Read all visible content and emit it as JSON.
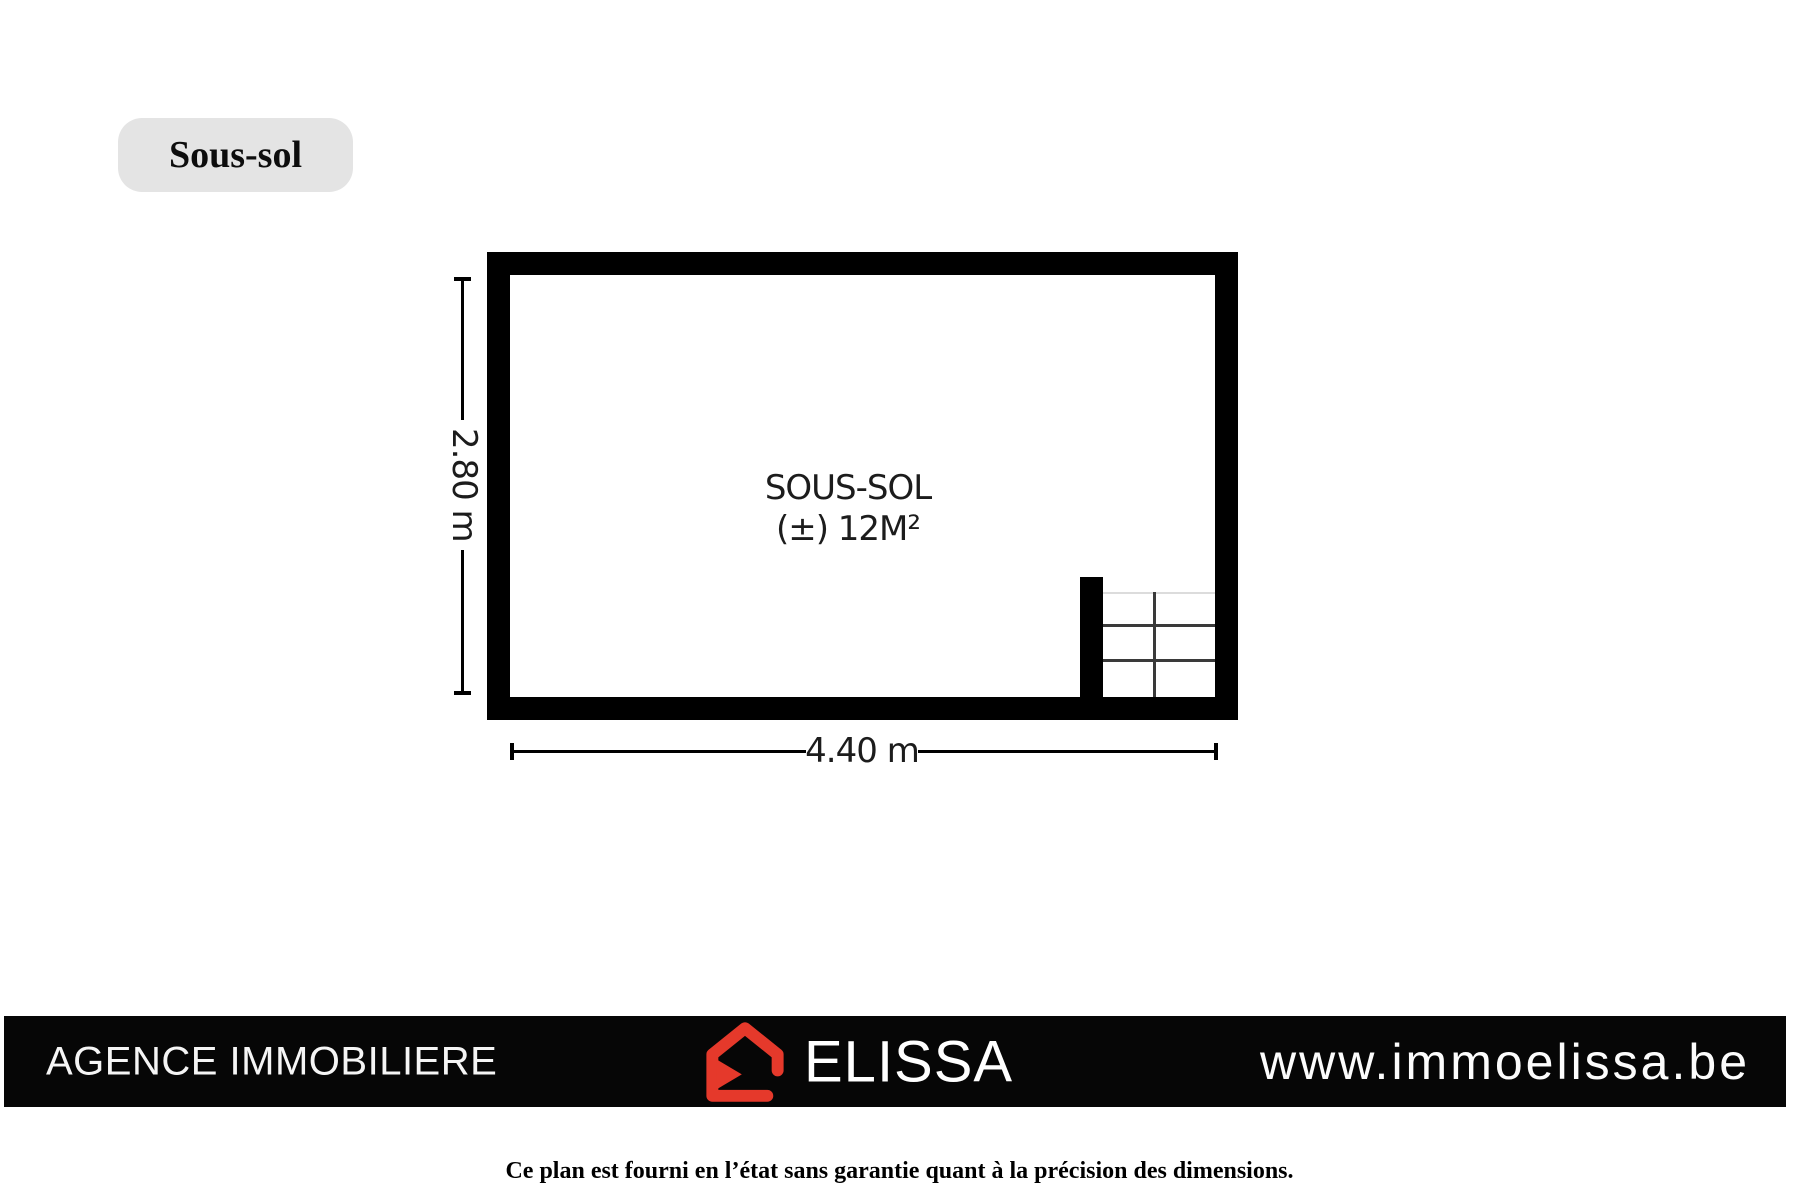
{
  "page": {
    "background": "#ffffff",
    "floor_badge": {
      "label": "Sous-sol",
      "bg_color": "#e4e4e4"
    },
    "disclaimer": "Ce plan est fourni en l’état sans garantie quant à la précision des dimensions."
  },
  "plan": {
    "wall_color": "#000000",
    "room": {
      "name": "SOUS-SOL",
      "area": "(±) 12M²"
    },
    "dimensions": {
      "height": "2.80 m",
      "width": "4.40 m"
    },
    "stairs": {
      "columns": 2,
      "rows": 3,
      "position": "bottom-right"
    }
  },
  "footer": {
    "bar_color": "#060606",
    "agency_text": "AGENCE IMMOBILIERE",
    "brand_name": "ELISSA",
    "website": "www.immoelissa.be",
    "logo_icon": "house-icon",
    "logo_color": "#e5392b",
    "text_color": "#ffffff"
  }
}
